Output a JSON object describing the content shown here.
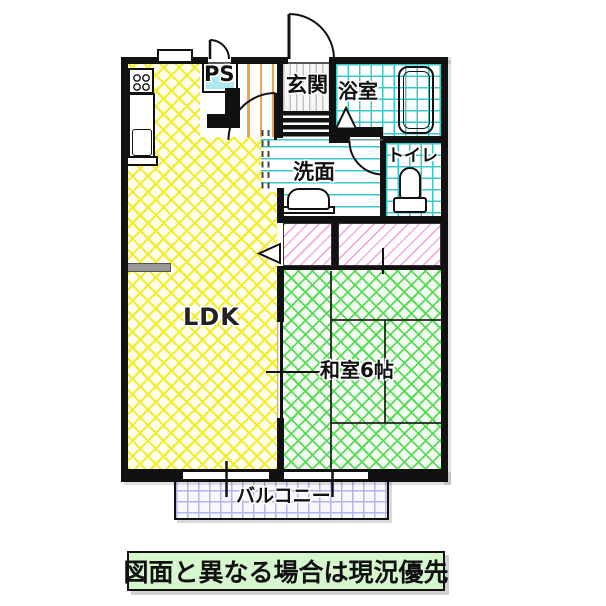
{
  "plan": {
    "rooms": {
      "ldk": {
        "label": "LDK"
      },
      "washitsu": {
        "label": "和室6帖"
      },
      "genkan": {
        "label": "玄関"
      },
      "bath": {
        "label": "浴室"
      },
      "washroom": {
        "label": "洗面"
      },
      "toilet": {
        "label": "トイレ"
      },
      "ps": {
        "label": "PS"
      },
      "balcony": {
        "label": "バルコニー"
      }
    },
    "colors": {
      "wall": "#111111",
      "ldk_hatch": "#f3ed2e",
      "washitsu_hatch": "#57dc57",
      "tile": "#38caca",
      "closet_hatch": "#f0abdf",
      "balcony_grid": "#b2b6e8",
      "hall_stripe": "#f2a24c",
      "ps_fill": "#aee8ee",
      "note_bg": "#d6f6ce"
    }
  },
  "note": {
    "text": "図面と異なる場合は現況優先"
  }
}
